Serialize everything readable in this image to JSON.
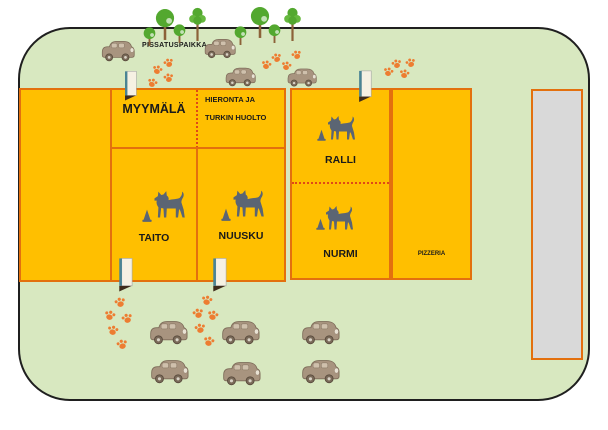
{
  "areas": {
    "myymala": {
      "label": "MYYMÄLÄ"
    },
    "hieronta": {
      "line1": "HIERONTA JA",
      "line2": "TURKIN HUOLTO"
    },
    "ralli": {
      "label": "RALLI"
    },
    "taito": {
      "label": "TAITO"
    },
    "nuusku": {
      "label": "NUUSKU"
    },
    "nurmi": {
      "label": "NURMI"
    },
    "pizzeria": {
      "label": "PIZZERIA"
    }
  },
  "outdoor": {
    "pissatuspaikka": "PISSATUSPAIKKA"
  },
  "colors": {
    "grounds_green": "#D8E8C0",
    "zone_fill": "#FFBF00",
    "zone_border": "#E3700E",
    "divider_dotted": "#E04818",
    "gray_building": "#D9D9D9",
    "map_outline": "#1F1F1F",
    "paw_orange": "#ED7D31",
    "dog_gray": "#5B6573",
    "tree_green": "#53A82F",
    "trunk_brown": "#8C6239",
    "car_taupe": "#A8947F",
    "door_teal": "#4A8494"
  },
  "icons": [
    "dog-icon",
    "training-cone-icon",
    "paw-print-icon",
    "tree-icon",
    "car-icon",
    "open-door-icon"
  ]
}
